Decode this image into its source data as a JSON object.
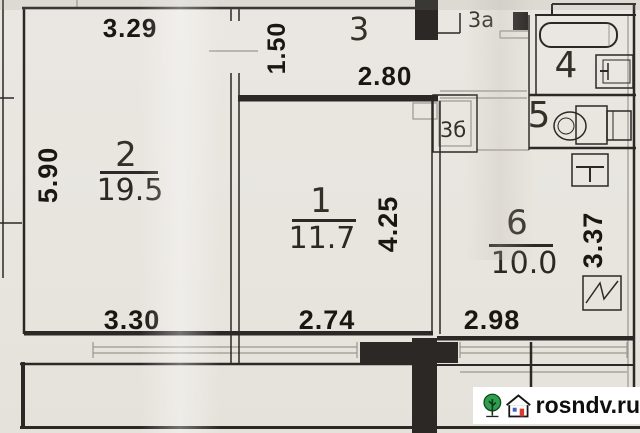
{
  "plan_title": "apartment floor plan",
  "rooms": {
    "r1": {
      "number": "1",
      "area": "11.7"
    },
    "r2": {
      "number": "2",
      "area": "19.5"
    },
    "r3": {
      "number": "3"
    },
    "r3a": {
      "number": "3а"
    },
    "r3b": {
      "number": "3б"
    },
    "r4": {
      "number": "4"
    },
    "r5": {
      "number": "5"
    },
    "r6": {
      "number": "6",
      "area": "10.0"
    }
  },
  "dimensions": {
    "room2_width": "3.29",
    "room2_height": "5.90",
    "hall3_width": "1.50",
    "hall3_length": "2.80",
    "room1_height": "4.25",
    "room1_width": "2.74",
    "room2_bottom": "3.30",
    "room6_height": "3.37",
    "room6_width": "2.98"
  },
  "watermark": {
    "domain": "rosndv.ru"
  },
  "colors": {
    "paper": "#e9e6e1",
    "ink": "#2b2826",
    "thin_line": "#9b978f",
    "logo_green": "#2e9e4f",
    "logo_red": "#d63b2f",
    "logo_blue": "#3a62c4"
  }
}
